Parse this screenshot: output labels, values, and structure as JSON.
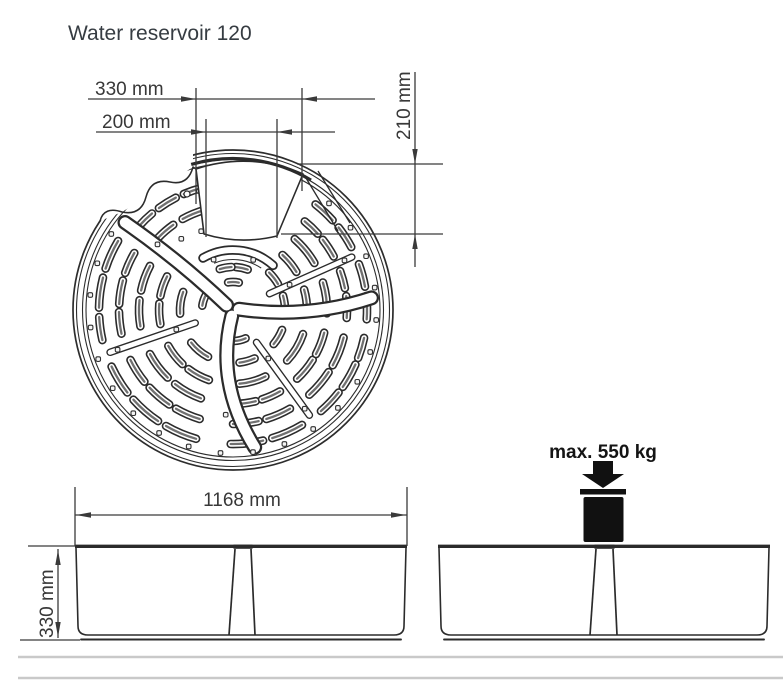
{
  "title": "Water reservoir 120",
  "top_view": {
    "opening_width_outer": "330 mm",
    "opening_width_inner": "200 mm",
    "opening_depth": "210 mm"
  },
  "side_view": {
    "overall_width": "1168 mm",
    "overall_height": "330 mm"
  },
  "load_view": {
    "max_load": "max. 550 kg"
  },
  "colors": {
    "ink": "#2b2b2b",
    "line": "#2d2d2d",
    "dim": "#3a3a3a",
    "slot_inner": "#707070",
    "ground": "#c9c9c9",
    "weight": "#111111"
  }
}
